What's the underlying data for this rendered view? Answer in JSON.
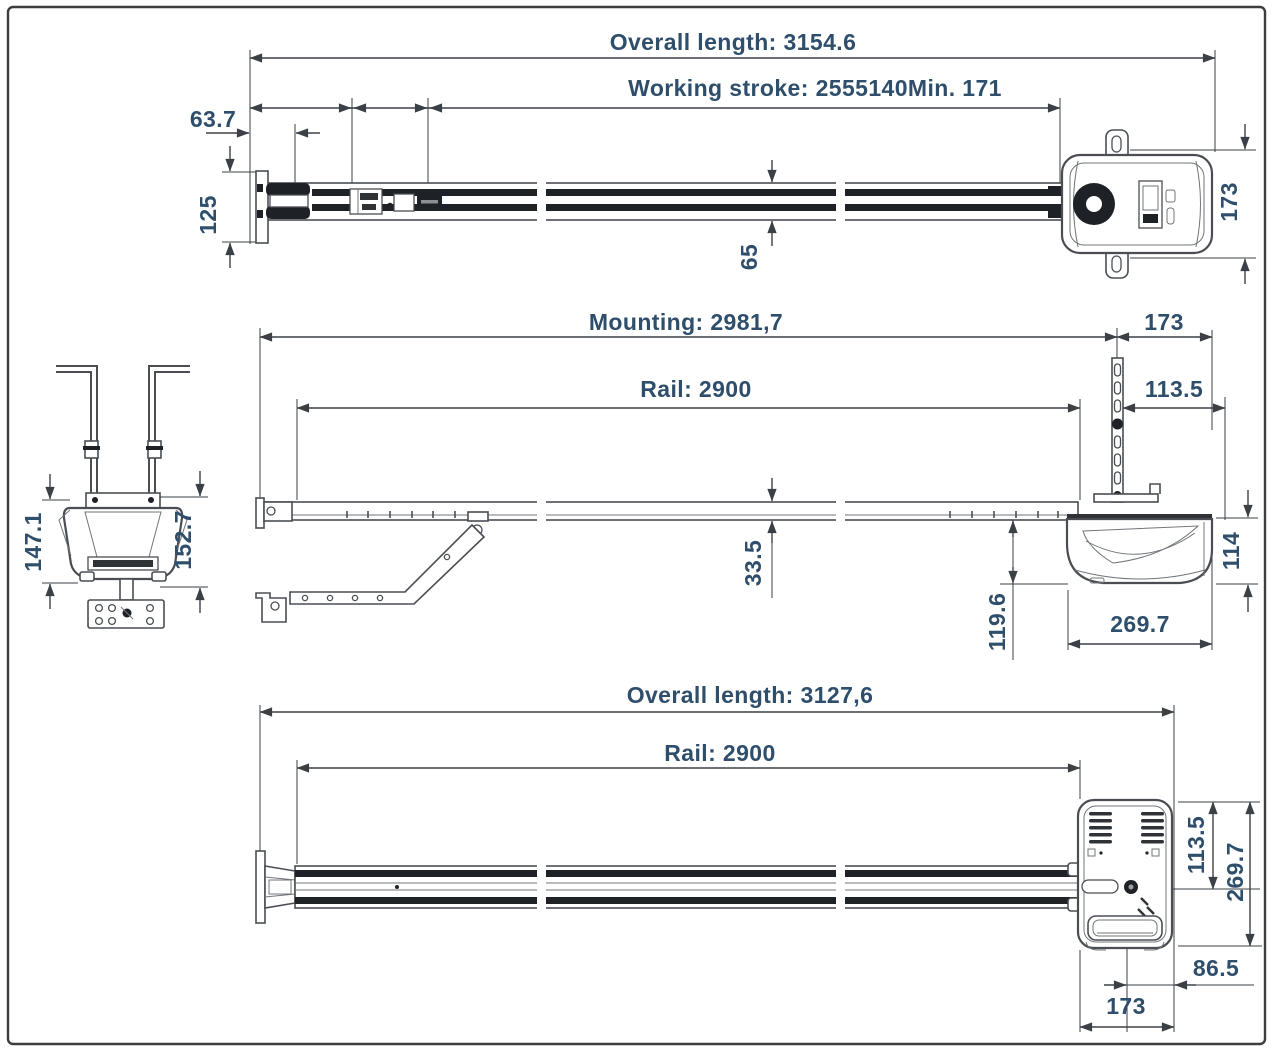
{
  "colors": {
    "dimension_text": "#2e4e6b",
    "line": "#3b4046",
    "frame": "#3d3d3d"
  },
  "views": {
    "top": {
      "overall": "Overall length: 3154.6",
      "working_stroke": "Working stroke: 2555140Min. 171",
      "left_offset": "63.7",
      "end_bracket_height": "125",
      "rail_width": "65",
      "head_width": "173"
    },
    "side": {
      "mounting": "Mounting: 2981,7",
      "head_overhang": "173",
      "rail": "Rail: 2900",
      "bracket_offset": "113.5",
      "rail_height": "33.5",
      "head_drop": "119.6",
      "head_length": "269.7",
      "head_height": "114"
    },
    "front": {
      "overall_height": "147.1",
      "total_height": "152.7"
    },
    "bottom": {
      "overall": "Overall length: 3127,6",
      "rail": "Rail: 2900",
      "shaft_offset": "113.5",
      "head_length": "269.7",
      "shaft_to_edge": "86.5",
      "head_width": "173"
    }
  }
}
